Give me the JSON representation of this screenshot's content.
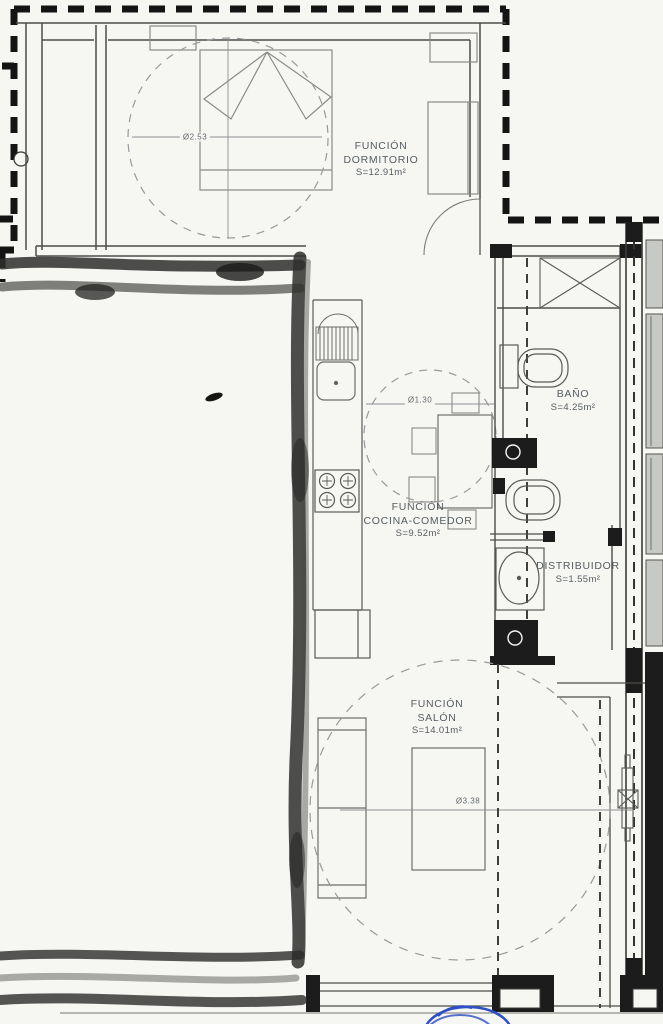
{
  "rooms": {
    "dormitorio": {
      "line1": "FUNCIÓN",
      "line2": "DORMITORIO",
      "area": "S=12.91m²",
      "circle_diameter": "Ø2.53"
    },
    "cocina": {
      "line1": "FUNCIÓN",
      "line2": "COCINA-COMEDOR",
      "area": "S=9.52m²",
      "circle_diameter": "Ø1.30"
    },
    "bano": {
      "line1": "BAÑO",
      "area": "S=4.25m²"
    },
    "distribuidor": {
      "line1": "DISTRIBUIDOR",
      "area": "S=1.55m²"
    },
    "salon": {
      "line1": "FUNCIÓN",
      "line2": "SALÓN",
      "area": "S=14.01m²",
      "circle_diameter": "Ø3.38"
    }
  },
  "colors": {
    "paper": "#f6f6f3",
    "ink": "#565d62",
    "wall": "#1c1c1c",
    "thin_line": "#5a5a58",
    "furniture": "#8a8a86",
    "clearance_dash": "#98999b",
    "scan_marker": "#2e2e2c",
    "window_fill": "#c7c9c6",
    "annotation_blue": "#2e4fc5"
  }
}
